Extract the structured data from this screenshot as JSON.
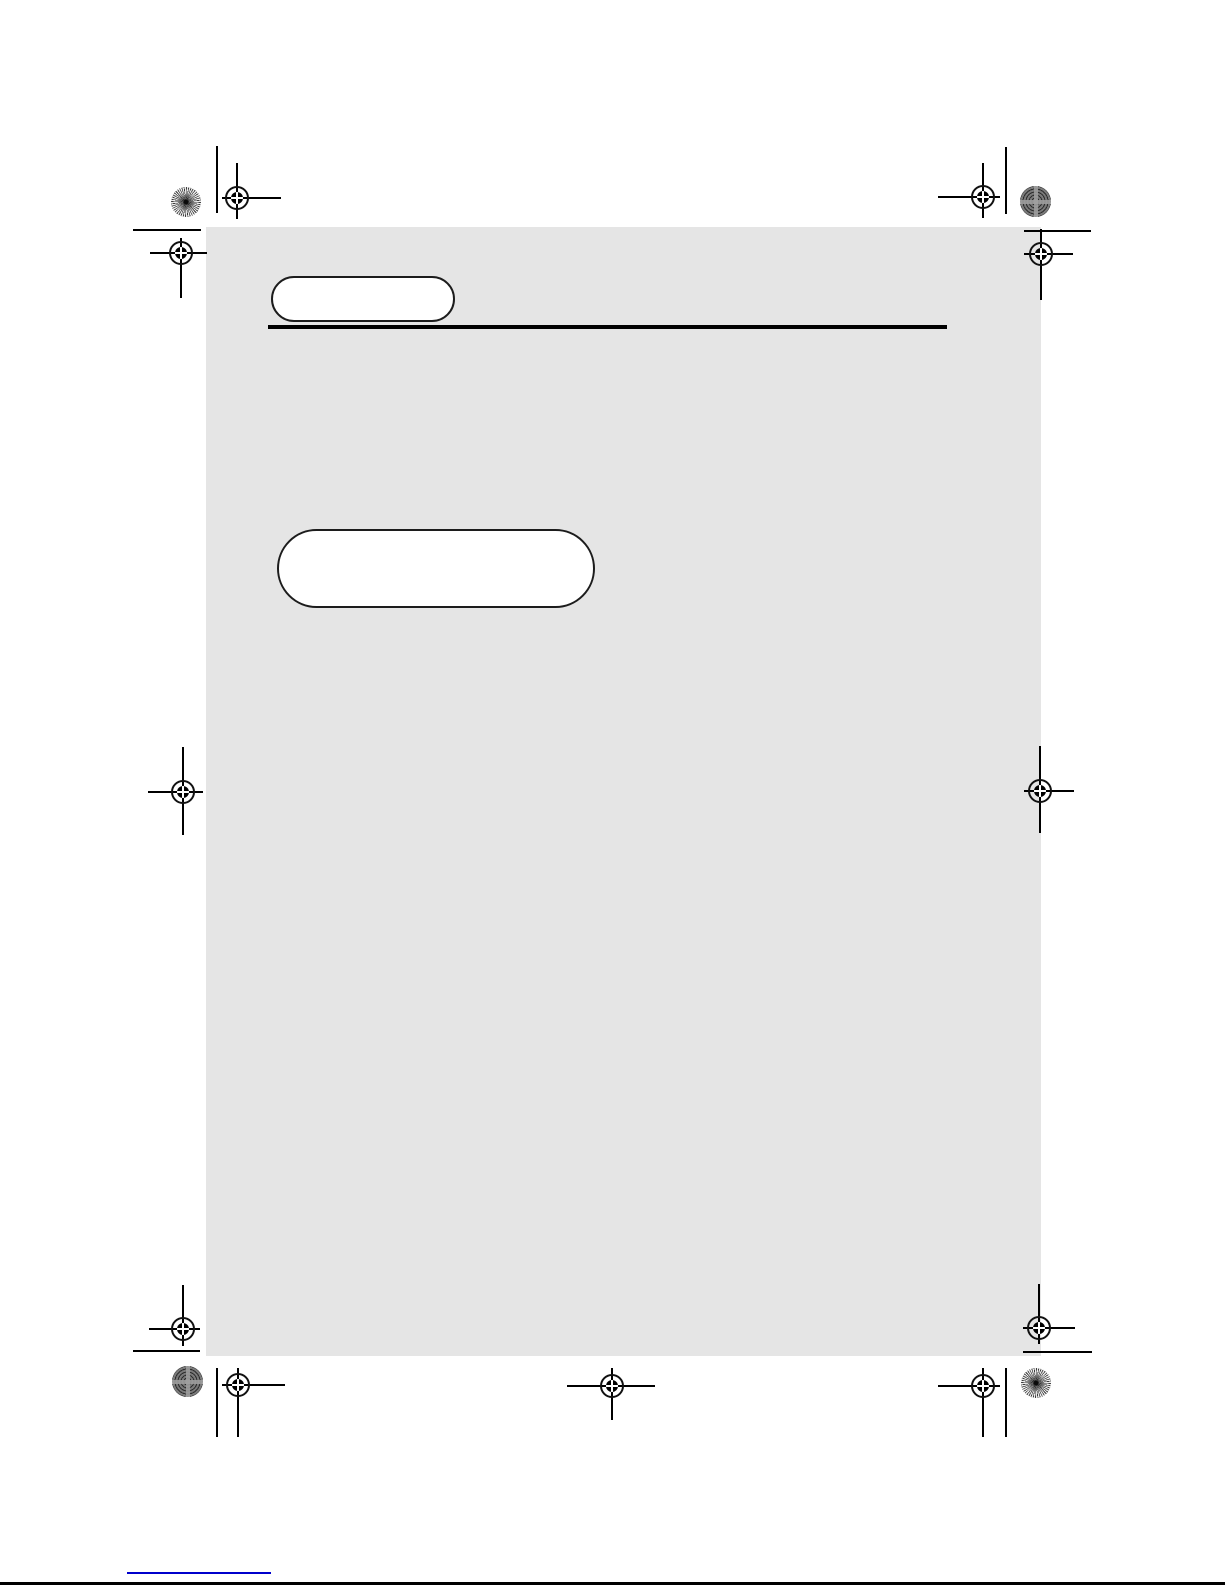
{
  "document": {
    "page_background": "#e5e5e5",
    "canvas_background": "#ffffff",
    "rule_color": "#000000",
    "pill_border_color": "#1c1c1c",
    "link_underline_color": "#0000cc",
    "small_callout_text": "",
    "large_callout_text": ""
  },
  "printer_marks": {
    "registration_mark_icon": "registration-crosshair-icon",
    "starburst_patch_icon": "starburst-pattern-icon",
    "moire_patch_icon": "moire-pattern-icon",
    "crop_mark_icon": "crop-line-icon",
    "registration_mark_count": 11,
    "color_patch_count": 4
  }
}
